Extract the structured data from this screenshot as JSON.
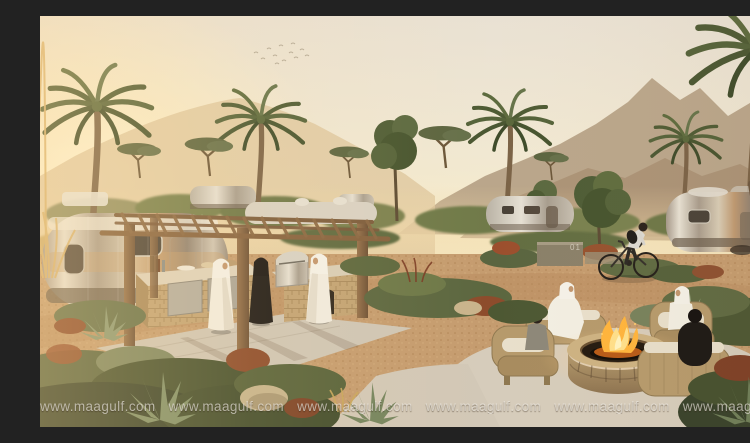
{
  "page": {
    "type": "photograph",
    "title": "Desert Airstream glamping resort at sunset"
  },
  "watermark": {
    "text": "www.maagulf.com",
    "repeats": 8
  },
  "site_marker": {
    "label": "01"
  },
  "scene": {
    "description": "Sunset rendering of a desert caravan resort: silver Airstream trailers among landscaped desert plants and palm trees, a timber pergola sheltering an outdoor barbecue kitchen where two men in white kanduras and a woman in a black abaya stand, a cyclist riding a gravel path past a stone site marker, and four people seated on wicker armchairs around a round stone fire pit, with hazy mountains and a flock of birds behind.",
    "people_count": 8,
    "colors": {
      "sky_top": "#e9e1d3",
      "sky_glow": "#fff3cf",
      "mountain_far": "#b49e83",
      "mountain_near": "#a58c70",
      "dune_haze": "#ddc59e",
      "ground_gravel": "#c59c6f",
      "patio_concrete": "#d2c9b8",
      "palm_green": "#55633a",
      "shrub_dark": "#3c452a",
      "shrub_rust": "#8a4a2c",
      "pergola_wood": "#85613e",
      "counter_stone": "#c2a374",
      "trailer_silver": "#cfc9bd",
      "kandura_white": "#f2eee2",
      "abaya_black": "#1d1916",
      "wicker": "#b69a6c",
      "cushion": "#e8dfcb",
      "flame_orange": "#ffb43c",
      "flame_yellow": "#ffe08a"
    }
  }
}
